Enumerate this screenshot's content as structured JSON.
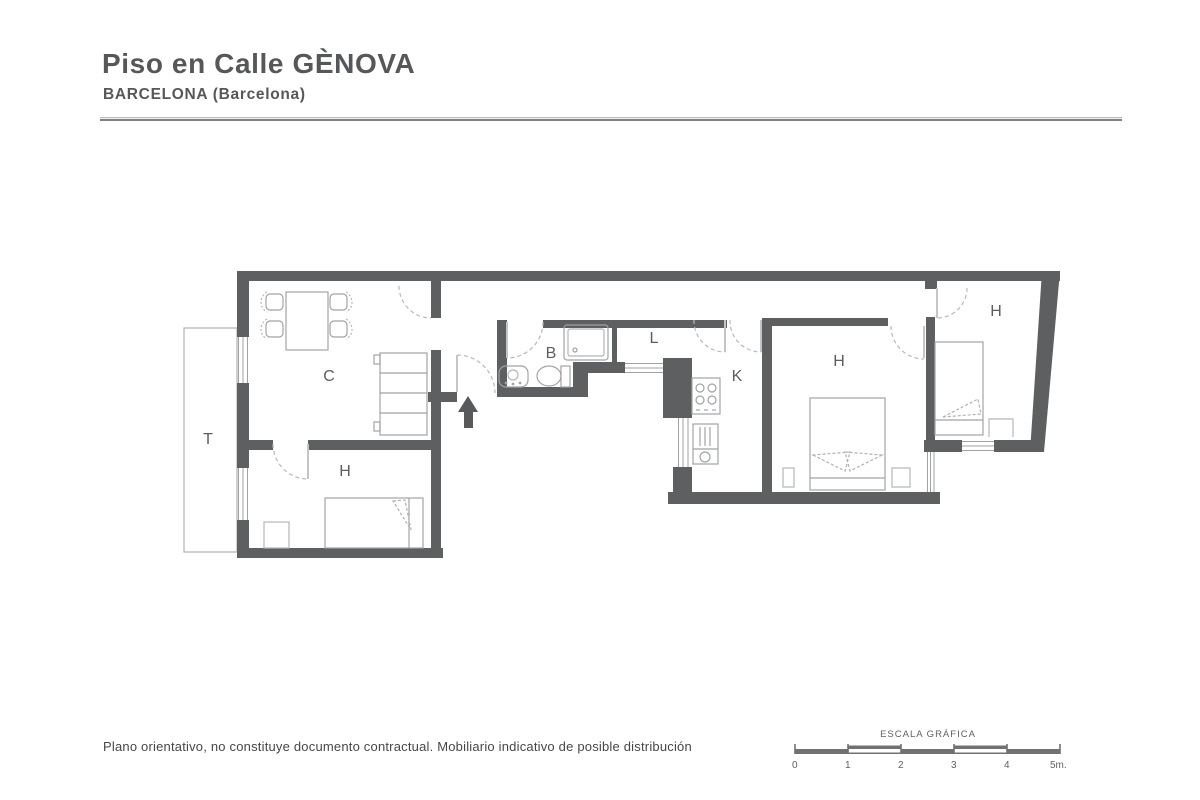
{
  "header": {
    "title": "Piso en Calle GÈNOVA",
    "subtitle": "BARCELONA (Barcelona)"
  },
  "floorplan": {
    "labels": {
      "terrace": "T",
      "dining": "C",
      "bedroom1": "H",
      "bathroom": "B",
      "laundry": "L",
      "kitchen": "K",
      "bedroom2": "H",
      "bedroom3": "H"
    }
  },
  "footer": {
    "disclaimer": "Plano orientativo, no constituye documento contractual. Mobiliario indicativo de posible distribución"
  },
  "scalebar": {
    "title": "ESCALA GRÁFICA",
    "ticks": [
      "0",
      "1",
      "2",
      "3",
      "4",
      "5m."
    ]
  },
  "colors": {
    "wall": "#5d5f61",
    "text": "#55575a",
    "furniture": "#a0a3a5"
  }
}
